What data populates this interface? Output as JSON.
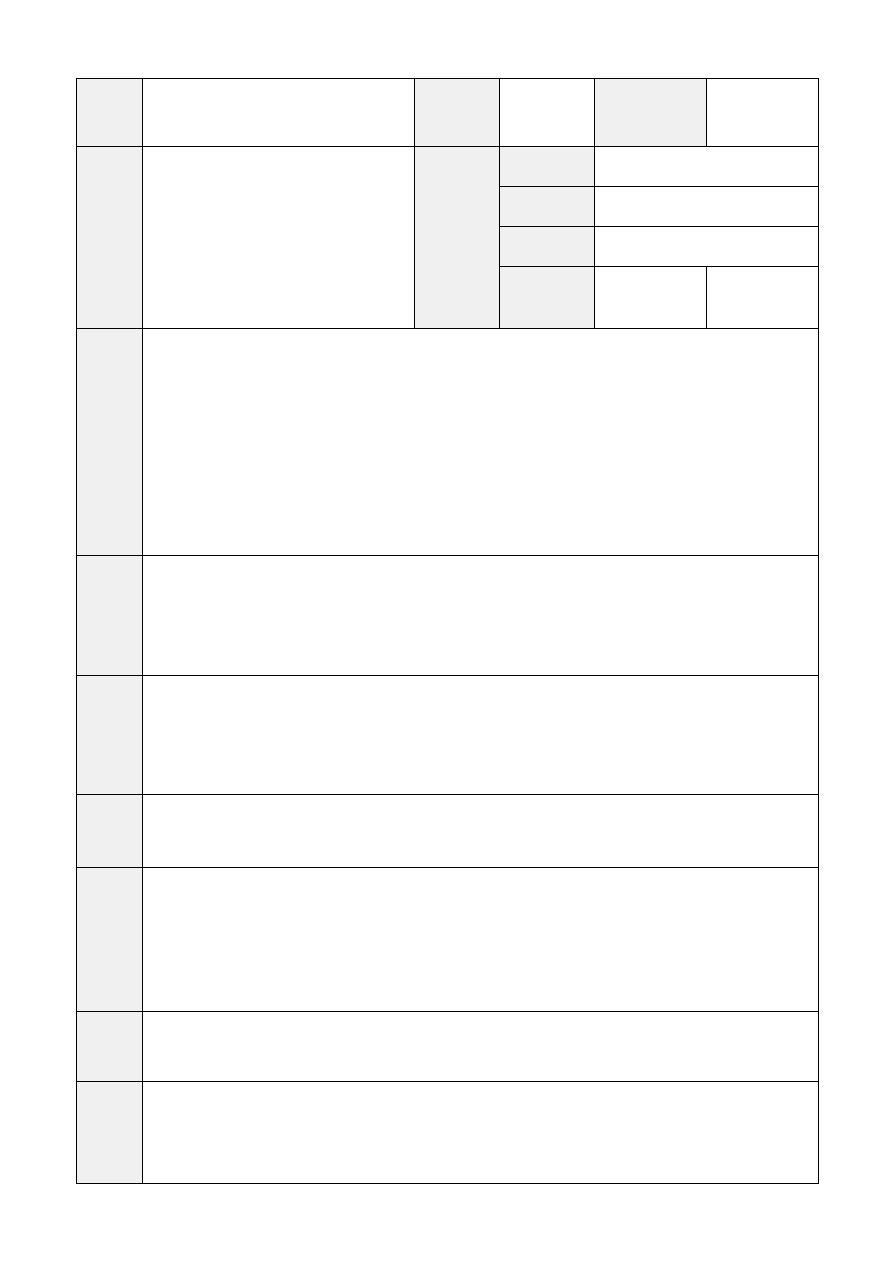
{
  "document": {
    "background": "#ffffff",
    "table": {
      "border_color": "#000000",
      "label_cell_fill": "#f0f0f0",
      "field_cell_fill": "#ffffff",
      "all_cells_empty": true,
      "cell_text": "",
      "structure": {
        "columns": 6,
        "column_widths_px": [
          66,
          272,
          85,
          95,
          112,
          112
        ],
        "row_heights_px": [
          68,
          182,
          227,
          120,
          119,
          73,
          144,
          70,
          102
        ],
        "header_block_subrow_heights_px": [
          40,
          40,
          40,
          62
        ]
      }
    }
  }
}
